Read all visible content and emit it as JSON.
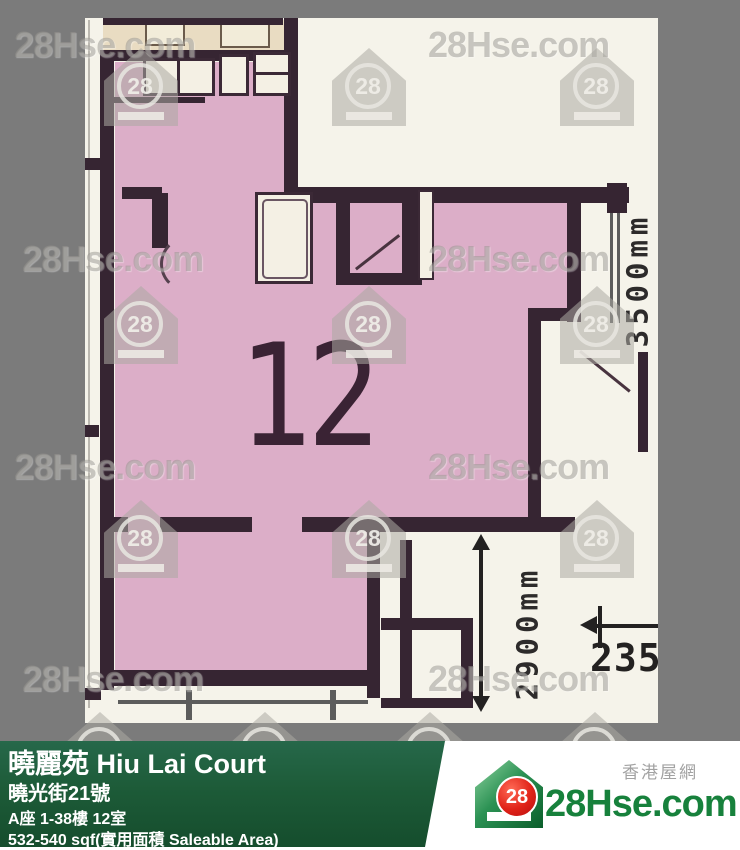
{
  "watermark": {
    "text": "28Hse.com",
    "logo_number": "28"
  },
  "plan": {
    "unit_label": "12",
    "dim_right": "3500mm",
    "dim_bottom": "2900mm",
    "dim_small": "2350"
  },
  "footer": {
    "estate": "曉麗苑 Hiu Lai Court",
    "street": "曉光街21號",
    "unit": "A座 1-38樓 12室",
    "area": "532-540 sqf(實用面積 Saleable Area)",
    "site_cn": "香港屋網",
    "site": "28Hse.com",
    "logo_number": "28"
  },
  "colors": {
    "background_gray": "#7b7b7b",
    "unit_fill": "#dcaec8",
    "wall": "#362532",
    "bar_green": "#1d5b38",
    "brand_green": "#17813c",
    "brand_red": "#e02318"
  }
}
